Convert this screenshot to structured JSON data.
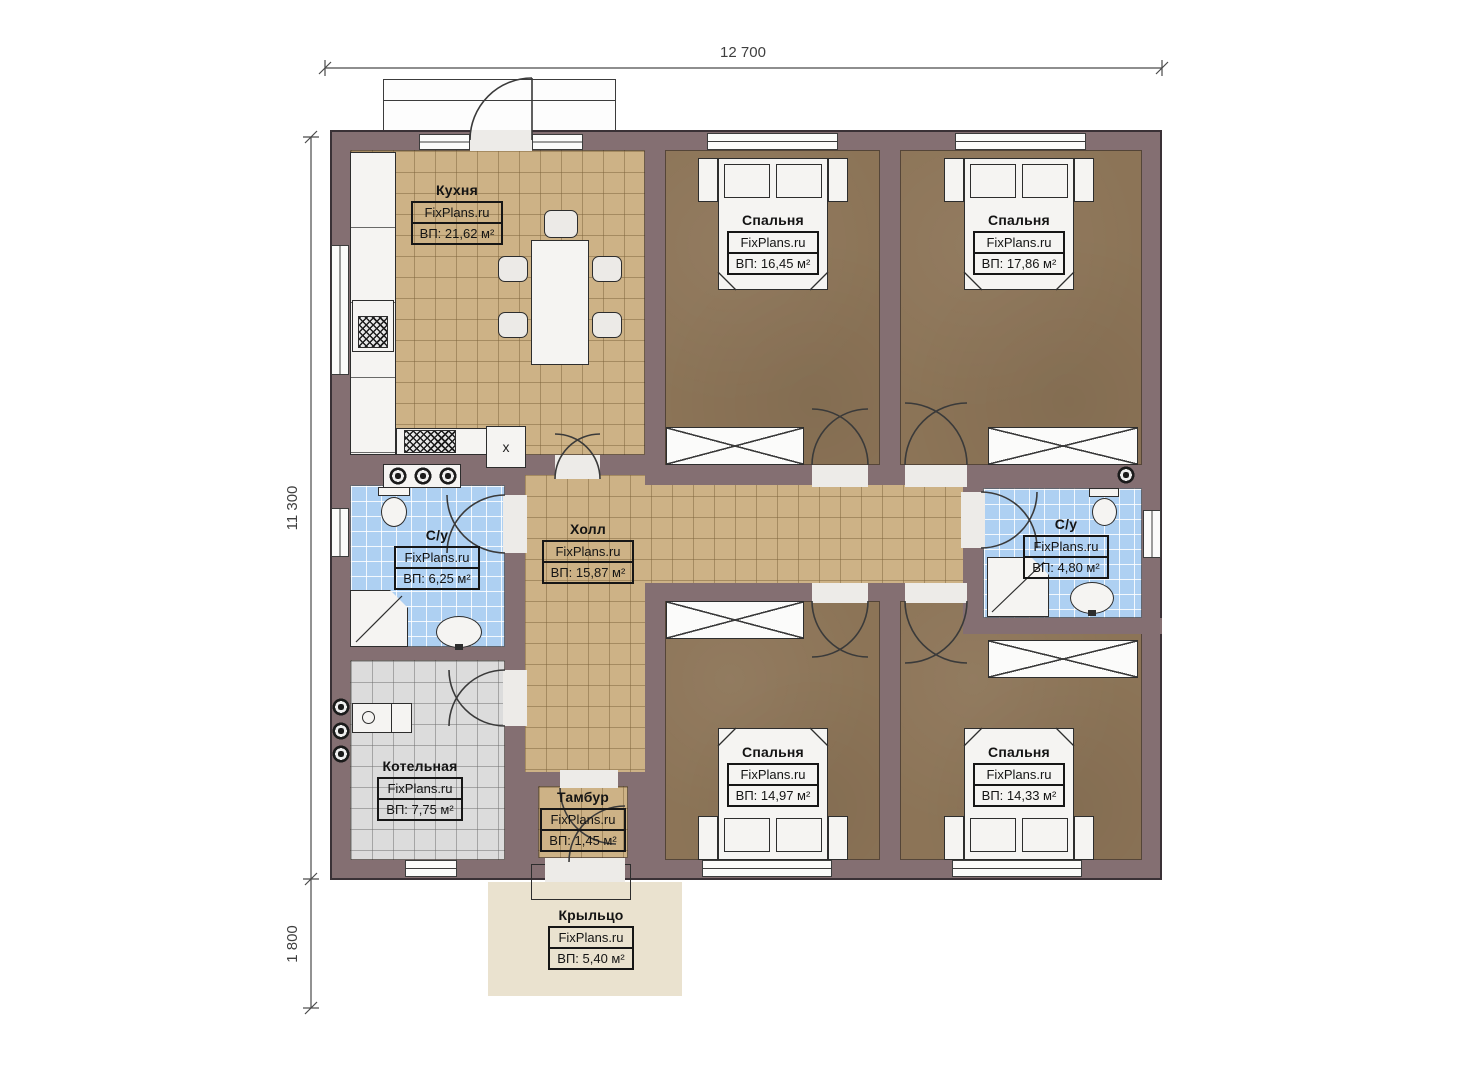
{
  "brand": "FixPlans.ru",
  "dimensions": {
    "top_width": "12 700",
    "left_height": "11 300",
    "porch_height": "1 800"
  },
  "rooms": {
    "kitchen": {
      "name": "Кухня",
      "area": "ВП: 21,62 м²"
    },
    "bedroom_tl": {
      "name": "Спальня",
      "area": "ВП: 16,45 м²"
    },
    "bedroom_tr": {
      "name": "Спальня",
      "area": "ВП: 17,86 м²"
    },
    "bath_left": {
      "name": "С/у",
      "area": "ВП: 6,25 м²"
    },
    "hall": {
      "name": "Холл",
      "area": "ВП: 15,87 м²"
    },
    "bath_right": {
      "name": "С/у",
      "area": "ВП: 4,80 м²"
    },
    "boiler": {
      "name": "Котельная",
      "area": "ВП: 7,75 м²"
    },
    "vestibule": {
      "name": "Тамбур",
      "area": "ВП: 1,45 м²"
    },
    "bedroom_bl": {
      "name": "Спальня",
      "area": "ВП: 14,97 м²"
    },
    "bedroom_br": {
      "name": "Спальня",
      "area": "ВП: 14,33 м²"
    },
    "porch": {
      "name": "Крыльцо",
      "area": "ВП: 5,40 м²"
    }
  },
  "kitchen_box_mark": "x",
  "colors": {
    "wall": "#846f72",
    "tile_tan": "#cdb286",
    "bedroom_floor": "#8c7457",
    "bath_floor": "#aed0f2",
    "boiler_floor": "#dcdcdc",
    "porch_floor": "#eae2cf"
  }
}
